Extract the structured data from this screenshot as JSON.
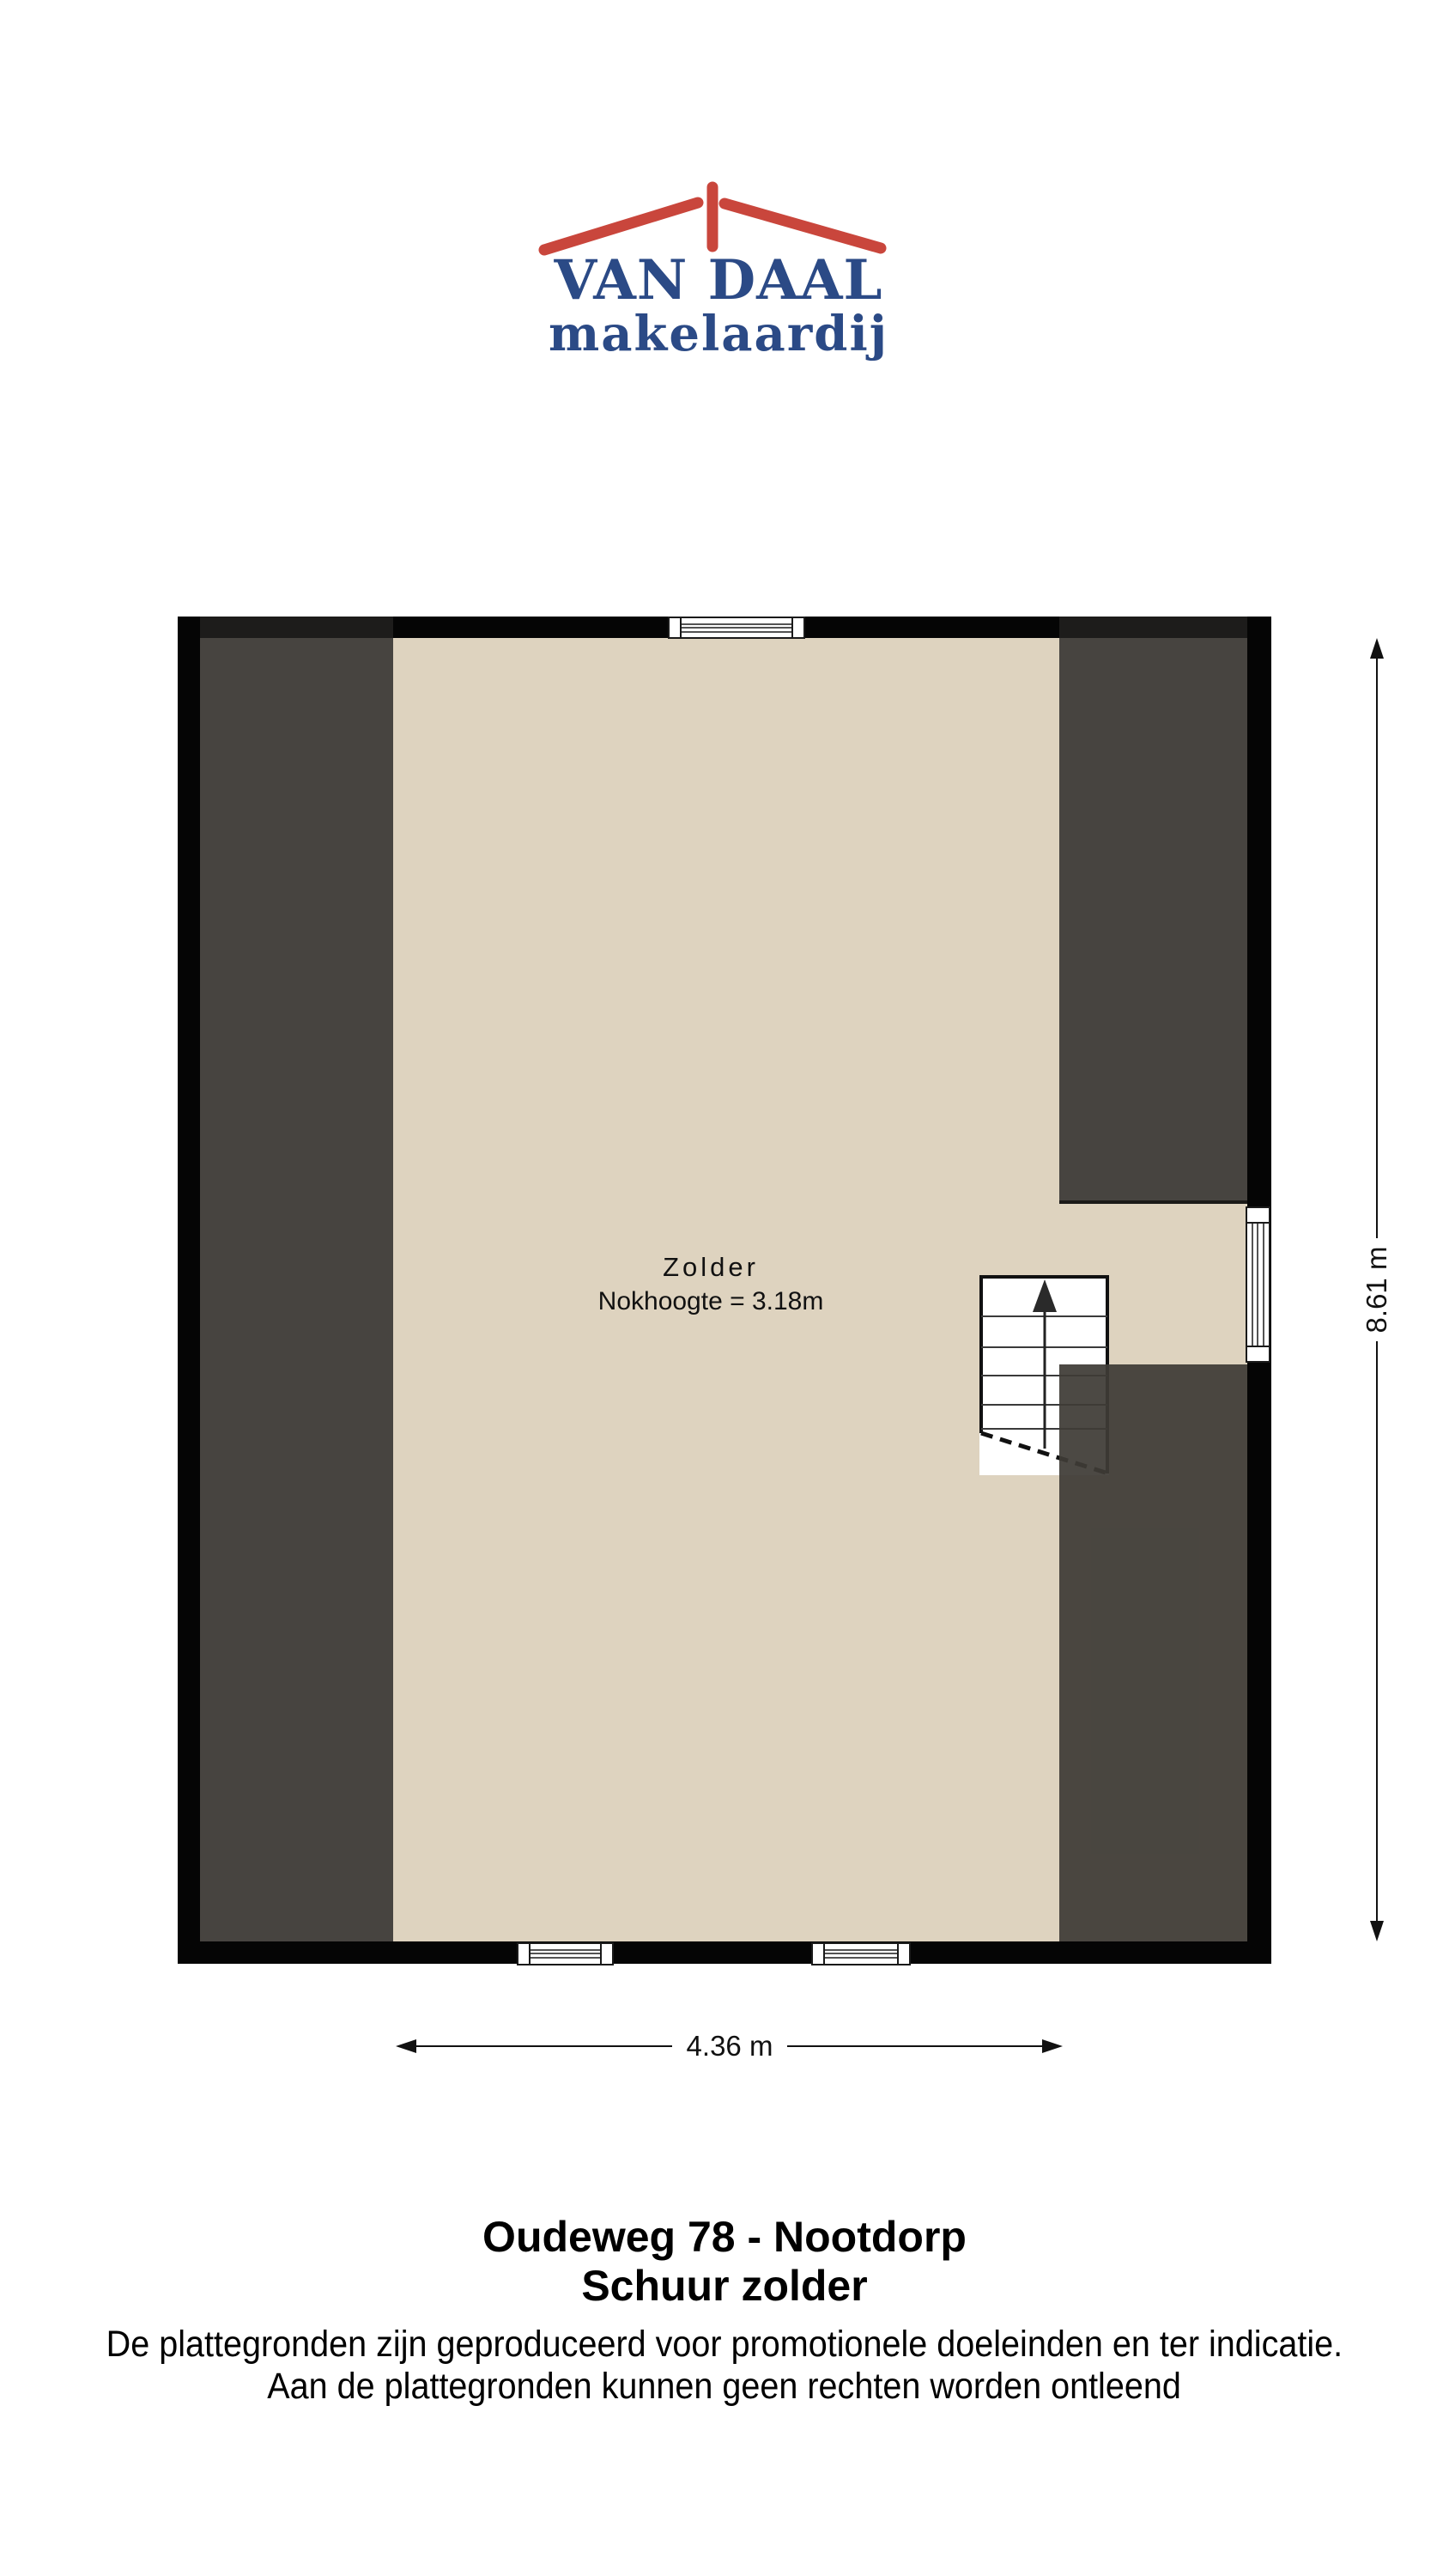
{
  "logo": {
    "title": "VAN DAAL",
    "subtitle": "makelaardij",
    "roof_color": "#c9463c",
    "text_color": "#2b4a86"
  },
  "plan": {
    "room_label": "Zolder",
    "room_note": "Nokhoogte = 3.18m",
    "height_dim": "8.61 m",
    "width_dim": "4.36 m",
    "floor_color": "#ded3bf",
    "roof_color": "#474440",
    "wall_color": "#050505"
  },
  "caption": {
    "address": "Oudeweg 78 - Nootdorp",
    "floor": "Schuur zolder"
  },
  "disclaimer": {
    "line1": "De plattegronden zijn geproduceerd voor promotionele doeleinden en ter indicatie.",
    "line2": "Aan de plattegronden kunnen geen rechten worden ontleend"
  }
}
